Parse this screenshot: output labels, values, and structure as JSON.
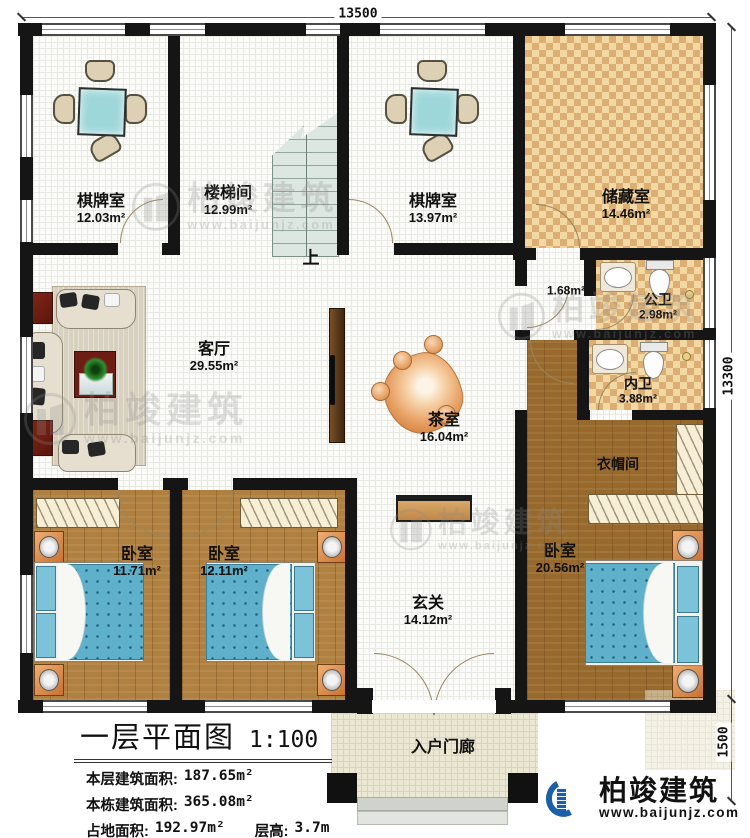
{
  "plan": {
    "dim_top": "13500",
    "dim_right": "13300",
    "dim_right_lower": "1500",
    "stairs_up": "上"
  },
  "rooms": {
    "chess1": {
      "name": "棋牌室",
      "area": "12.03m²"
    },
    "stairwell": {
      "name": "楼梯间",
      "area": "12.99m²"
    },
    "chess2": {
      "name": "棋牌室",
      "area": "13.97m²"
    },
    "storage": {
      "name": "储藏室",
      "area": "14.46m²"
    },
    "hallway": {
      "area": "1.68m²"
    },
    "public_bath": {
      "name": "公卫",
      "area": "2.98m²"
    },
    "private_bath": {
      "name": "内卫",
      "area": "3.88m²"
    },
    "cloakroom": {
      "name": "衣帽间"
    },
    "living": {
      "name": "客厅",
      "area": "29.55m²"
    },
    "tea": {
      "name": "茶室",
      "area": "16.04m²"
    },
    "bedroom1": {
      "name": "卧室",
      "area": "11.71m²"
    },
    "bedroom2": {
      "name": "卧室",
      "area": "12.11m²"
    },
    "bedroom_master": {
      "name": "卧室",
      "area": "20.56m²"
    },
    "foyer": {
      "name": "玄关",
      "area": "14.12m²"
    },
    "porch": {
      "name": "入户门廊"
    }
  },
  "title_block": {
    "title": "一层平面图",
    "scale": "1:100",
    "row1_label": "本层建筑面积:",
    "row1_value": "187.65m²",
    "row2_label": "本栋建筑面积:",
    "row2_value": "365.08m²",
    "row3_label": "占地面积:",
    "row3_value": "192.97m²",
    "row3b_label": "层高:",
    "row3b_value": "3.7m"
  },
  "brand": {
    "name": "柏竣建筑",
    "url": "www.baijunjz.com"
  },
  "watermark": {
    "name": "柏竣建筑",
    "url": "www.baijunjz.com"
  }
}
